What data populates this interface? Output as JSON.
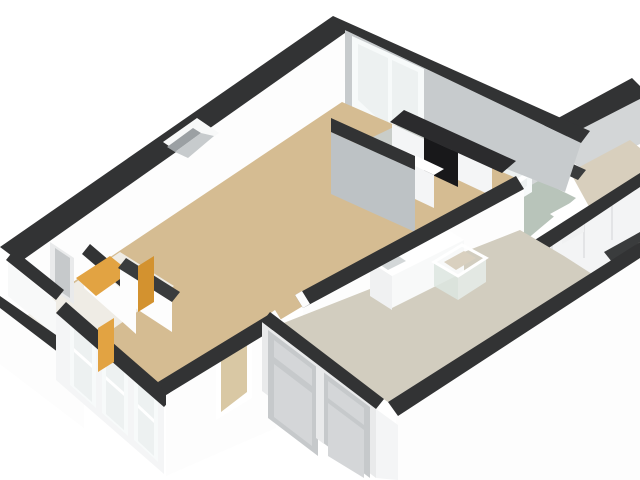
{
  "scene": {
    "type": "3d-floorplan-isometric-render",
    "background": "#ffffff",
    "description": "Cut-away 3D floor plan of an apartment viewed from above at an angle; no text labels rendered"
  },
  "palette": {
    "bg": "#ffffff",
    "wall_cap": "#323334",
    "wall_cap_soft": "#3a3c3d",
    "wall_white": "#fdfdfd",
    "wall_white_warm": "#f8f9f9",
    "wall_white_shade": "#f4f5f6",
    "wall_gray": "#c7cbcd",
    "wall_gray_mid": "#bdc2c5",
    "wall_gray_dark": "#9ba0a3",
    "wing_wall_gray": "#d3d6d7",
    "floor_living": "#d5bc92",
    "floor_hall": "#efece5",
    "floor_kitchen": "#c9cdc9",
    "floor_utility": "#d2cdbf",
    "floor_bath_green": "#b8c4ba",
    "floor_bedroom": "#d8cfbd",
    "floor_sliver": "#d9d0bf",
    "door_orange": "#e2a342",
    "door_orange_deep": "#d3922f",
    "door_panel_gray": "#c6c9cb",
    "door_panel_light": "#d4d6d8",
    "door_frame": "#e9eaeb",
    "glass": "#edf1f1",
    "glass_bright": "#f7fafa",
    "glass_interior_beige": "#d9c8a4",
    "counter_dark": "#2b2b2d",
    "appliance_black": "#18181a",
    "appliance_handle": "#8a8d8f",
    "fixture_white": "#ffffff",
    "fixture_front": "#f0f1f2",
    "sink_basin": "#d3d7d8",
    "shower_glass": "#dde6e1",
    "shower_glass_side": "#e6ece9",
    "wardrobe_white": "#f3f4f5",
    "wardrobe_seam": "#d8dadb"
  },
  "rooms": [
    {
      "name": "living-room",
      "floor_ref": "floor_living"
    },
    {
      "name": "kitchen",
      "floor_ref": "floor_kitchen"
    },
    {
      "name": "entry-hall",
      "floor_ref": "floor_hall"
    },
    {
      "name": "utility-room",
      "floor_ref": "floor_utility"
    },
    {
      "name": "bathroom-corridor",
      "floor_ref": "floor_bath_green"
    },
    {
      "name": "bedroom-top-right",
      "floor_ref": "floor_bedroom"
    },
    {
      "name": "side-room-sliver",
      "floor_ref": "floor_sliver"
    }
  ],
  "fixtures": [
    {
      "name": "kitchen-counter",
      "color_ref": "counter_dark"
    },
    {
      "name": "built-in-oven-column",
      "color_ref": "appliance_black"
    },
    {
      "name": "sink-counter-unit",
      "color_ref": "fixture_white"
    },
    {
      "name": "shower-cubicle",
      "color_ref": "shower_glass"
    },
    {
      "name": "wardrobe-sliding-doors",
      "color_ref": "wardrobe_white"
    },
    {
      "name": "washer-box",
      "color_ref": "fixture_white"
    }
  ],
  "openings": [
    {
      "name": "big-window-north",
      "color_ref": "glass"
    },
    {
      "name": "bay-windows-southwest",
      "count": 3,
      "color_ref": "glass"
    },
    {
      "name": "small-window-south",
      "color_ref": "glass_interior_beige"
    },
    {
      "name": "paneled-double-doors-exterior",
      "color_ref": "door_panel_gray"
    },
    {
      "name": "glass-door-right-wing",
      "color_ref": "glass"
    },
    {
      "name": "orange-interior-doors",
      "count": 3,
      "color_ref": "door_orange"
    },
    {
      "name": "narrow-gray-door-left-room",
      "color_ref": "door_panel_gray"
    },
    {
      "name": "wall-niche",
      "color_ref": "wall_gray_dark"
    }
  ]
}
